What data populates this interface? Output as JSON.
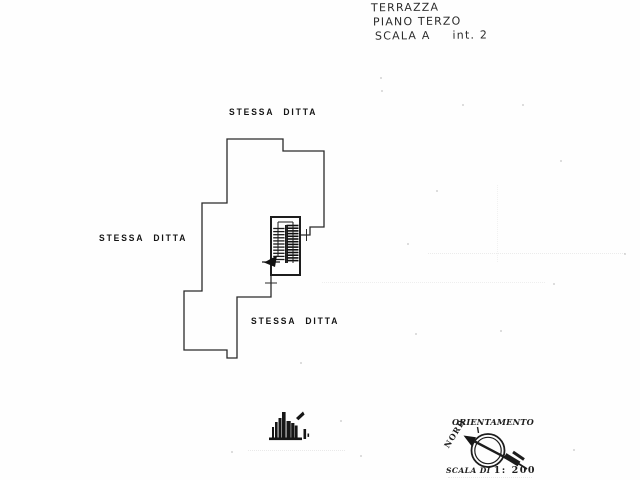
{
  "colors": {
    "ink": "#262626",
    "label_ink": "#141414",
    "paper": "#fefefe"
  },
  "annotations": {
    "line1": "TERRAZZA",
    "line2": "PIANO TERZO",
    "scala": "SCALA A",
    "interno": "int. 2"
  },
  "plan_labels": {
    "top": "STESSA DITTA",
    "left": "STESSA DITTA",
    "bottom": "STESSA DITTA"
  },
  "orientation_stamp": {
    "title": "ORIENTAMENTO",
    "north": "NORD",
    "scale_prefix": "SCALA DI",
    "scale_value": "1: 200"
  }
}
